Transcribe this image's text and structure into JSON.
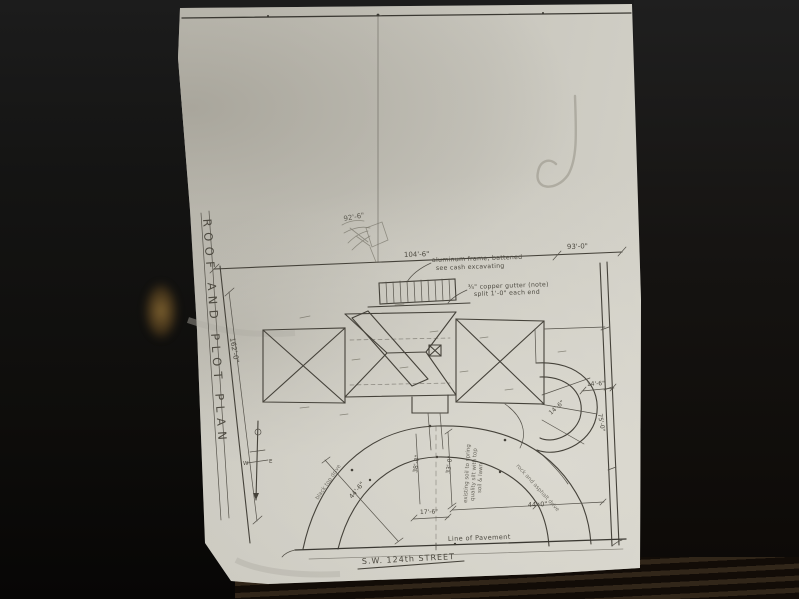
{
  "colors": {
    "background": "#0e0d0b",
    "paper": "#c9c7be",
    "pencil": "#45423a",
    "reflection": "#a07a3c"
  },
  "sheet": {
    "title": "ROOF AND PLOT PLAN",
    "street": "S.W. 124th STREET",
    "pavement": "Line of Pavement"
  },
  "dims": {
    "lot_width": "104'-6\"",
    "lot_width_right": "93'-0\"",
    "lot_depth": "162'-0\"",
    "drive_span_left": "17'-6\"",
    "drive_span_right": "44'-0\"",
    "drive_depth": "33'-0\"",
    "drive_radius": "44'-6\"",
    "walk_depth": "38'-0\"",
    "turnaround": "14'-6\"",
    "turnaround_inner": "14'-6\"",
    "right_depth": "75'-0\""
  },
  "notes": {
    "frame1": "aluminum frame, battened",
    "frame2": "see cash excavating",
    "gutter1": "¾\" copper gutter (note)",
    "gutter2": "split 1'-0\" each end",
    "pencil_calc": "92'-6\"",
    "soil1": "existing soil to spring",
    "soil2": "quality silt with top",
    "soil3": "soil & lawn",
    "drive_left": "black top drive",
    "drive_right": "rock and asphalt drive",
    "compass_w": "W",
    "compass_e": "E"
  }
}
